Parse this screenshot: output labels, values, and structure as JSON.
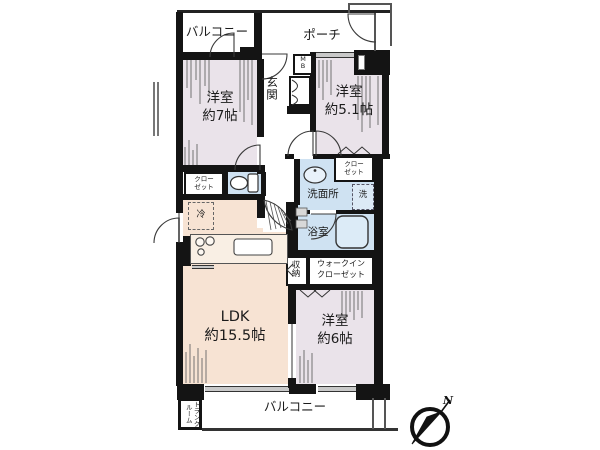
{
  "floor_plan": {
    "outdoor": {
      "balcony_top": "バルコニー",
      "porch": "ポーチ",
      "balcony_bottom": "バルコニー",
      "trunk_room": "トランク\nルーム"
    },
    "entrance": {
      "genkan": "玄関",
      "meter_box": "M\nB"
    },
    "rooms": {
      "bedroom_7": "洋室\n約7帖",
      "bedroom_5_1": "洋室\n約5.1帖",
      "bedroom_6": "洋室\n約6帖",
      "ldk": "LDK\n約15.5帖"
    },
    "storage": {
      "closet_7": "クロー\nゼット",
      "closet_5_1": "クロー\nゼット",
      "walk_in_closet": "ウォークイン\nクローゼット",
      "shuno": "収納"
    },
    "wet_areas": {
      "washroom": "洗面所",
      "washer": "洗",
      "bathroom": "浴室"
    },
    "appliances": {
      "refrigerator": "冷"
    },
    "compass": {
      "north": "N"
    },
    "colors": {
      "wall": "#141414",
      "bedroom_fill": "#eae3ea",
      "ldk_fill": "#f7e3d3",
      "wet_fill": "#cfe2f2",
      "window_gray": "#c9c9c9"
    }
  }
}
